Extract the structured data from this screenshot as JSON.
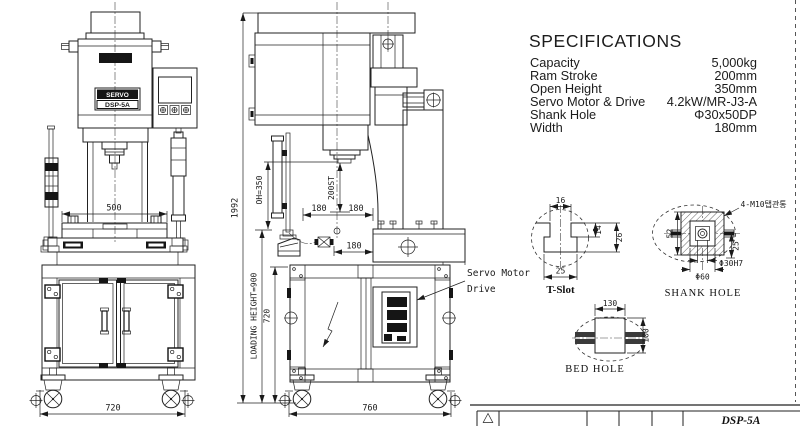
{
  "specs": {
    "title": "SPECIFICATIONS",
    "rows": [
      {
        "label": "Capacity",
        "value": "5,000kg"
      },
      {
        "label": "Ram Stroke",
        "value": "200mm"
      },
      {
        "label": "Open Height",
        "value": "350mm"
      },
      {
        "label": "Servo Motor & Drive",
        "value": "4.2kW/MR-J3-A"
      },
      {
        "label": "Shank Hole",
        "value": "Φ30x50DP"
      },
      {
        "label": "Width",
        "value": "180mm"
      }
    ]
  },
  "front_view": {
    "brand": "HanJin",
    "plate_top": "SERVO",
    "plate_model": "DSP-5A",
    "dim_table": "500",
    "dim_base": "720"
  },
  "side_view": {
    "dim_total": "1992",
    "dim_open_height": "OH=350",
    "dim_stroke": "200ST",
    "dim_180_left": "180",
    "dim_180_right": "180",
    "dim_180_lower": "180",
    "dim_loading": "LOADING HEIGHT=900",
    "dim_cabinet": "720",
    "dim_base": "760",
    "servo_line1": "Servo Motor",
    "servo_line2": "Drive"
  },
  "t_slot": {
    "dim_top": "16",
    "dim_depth1": "14",
    "dim_depth2": "26",
    "dim_bottom": "25",
    "label": "T-Slot"
  },
  "shank_hole": {
    "tap_label": "4-M10탭관통",
    "dim_left": "52",
    "dim_right": "25",
    "dim_hole": "Φ30H7",
    "dim_outer": "Φ60",
    "label": "SHANK HOLE"
  },
  "bed_hole": {
    "dim_width": "130",
    "dim_height": "100",
    "label": "BED HOLE"
  },
  "title_block": {
    "model": "DSP-5A"
  }
}
